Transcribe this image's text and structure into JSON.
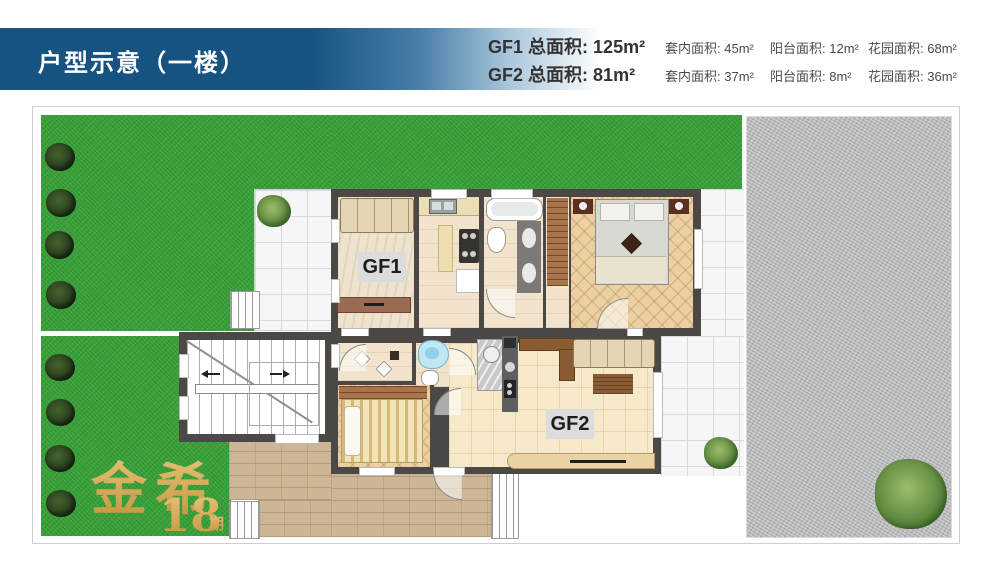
{
  "header": {
    "title": "户型示意（一楼）"
  },
  "stats": {
    "rows": [
      {
        "unit": "GF1",
        "total_label": "总面积:",
        "total_value": "125m²",
        "details": [
          {
            "label": "套内面积:",
            "value": "45m²"
          },
          {
            "label": "阳台面积:",
            "value": "12m²"
          },
          {
            "label": "花园面积:",
            "value": "68m²"
          }
        ]
      },
      {
        "unit": "GF2",
        "total_label": "总面积:",
        "total_value": "81m²",
        "details": [
          {
            "label": "套内面积:",
            "value": "37m²"
          },
          {
            "label": "阳台面积:",
            "value": "8m²"
          },
          {
            "label": "花园面积:",
            "value": "36m²"
          }
        ]
      }
    ]
  },
  "plan": {
    "unit1_label": "GF1",
    "unit2_label": "GF2",
    "watermark": {
      "brand": "金希",
      "number": "18",
      "suffix": "期"
    }
  },
  "colors": {
    "banner_blue": "#175381",
    "wall_dark": "#4b4846",
    "grass_green": "#3ba23b",
    "gravel_gray": "#b9babc",
    "watermark_gold": "#cfa14e"
  }
}
